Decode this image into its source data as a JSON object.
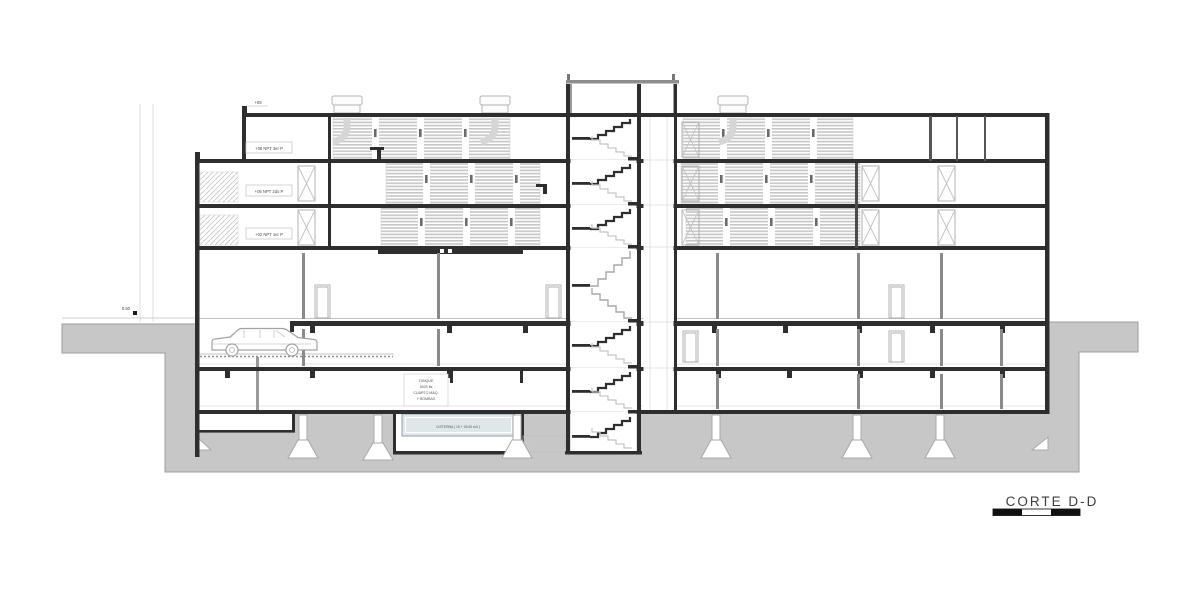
{
  "drawing": {
    "title": "CORTE D-D",
    "levels": {
      "roof": "+09",
      "third": "+08 NPT 3er P",
      "second": "+05 NPT 2do P",
      "first": "+02 NPT 1er P",
      "street": "0.50"
    },
    "annotations": {
      "tank_line1": "TANQUE",
      "tank_line2": "5000 lts",
      "tank_line3": "CUARTO MAQ.",
      "tank_line4": "Y BOMBAS",
      "cistern": "CISTERNA ( 15 + 35.00 m3 )"
    },
    "colors": {
      "ground": "#c7c7c7",
      "ink": "#2e2e2e",
      "light_line": "#b9b9b9",
      "cistern_fill": "#dfe7e9"
    }
  }
}
